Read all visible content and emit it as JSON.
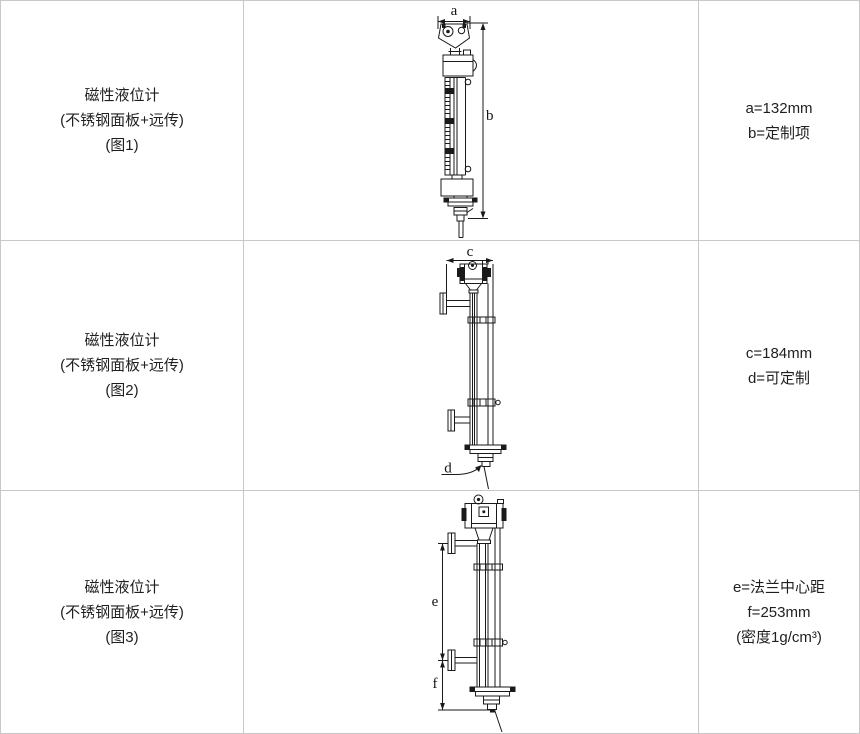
{
  "colors": {
    "line": "#1a1a1a",
    "grid": "#c8c8c8",
    "background": "#ffffff",
    "text": "#1f1f1f"
  },
  "table": {
    "rows": [
      {
        "product": {
          "title": "磁性液位计",
          "subtitle": "(不锈钢面板+远传)",
          "figure_no": "(图1)"
        },
        "figure": {
          "dim_width_label": "a",
          "dim_height_label": "b"
        },
        "specs": [
          "a=132mm",
          "b=定制项"
        ]
      },
      {
        "product": {
          "title": "磁性液位计",
          "subtitle": "(不锈钢面板+远传)",
          "figure_no": "(图2)"
        },
        "figure": {
          "dim_width_label": "c",
          "dim_height_label": "d"
        },
        "specs": [
          "c=184mm",
          "d=可定制"
        ]
      },
      {
        "product": {
          "title": "磁性液位计",
          "subtitle": "(不锈钢面板+远传)",
          "figure_no": "(图3)"
        },
        "figure": {
          "dim_width_label": "e",
          "dim_height_label": "f"
        },
        "specs": [
          "e=法兰中心距",
          "f=253mm",
          "(密度1g/cm³)"
        ]
      }
    ]
  }
}
